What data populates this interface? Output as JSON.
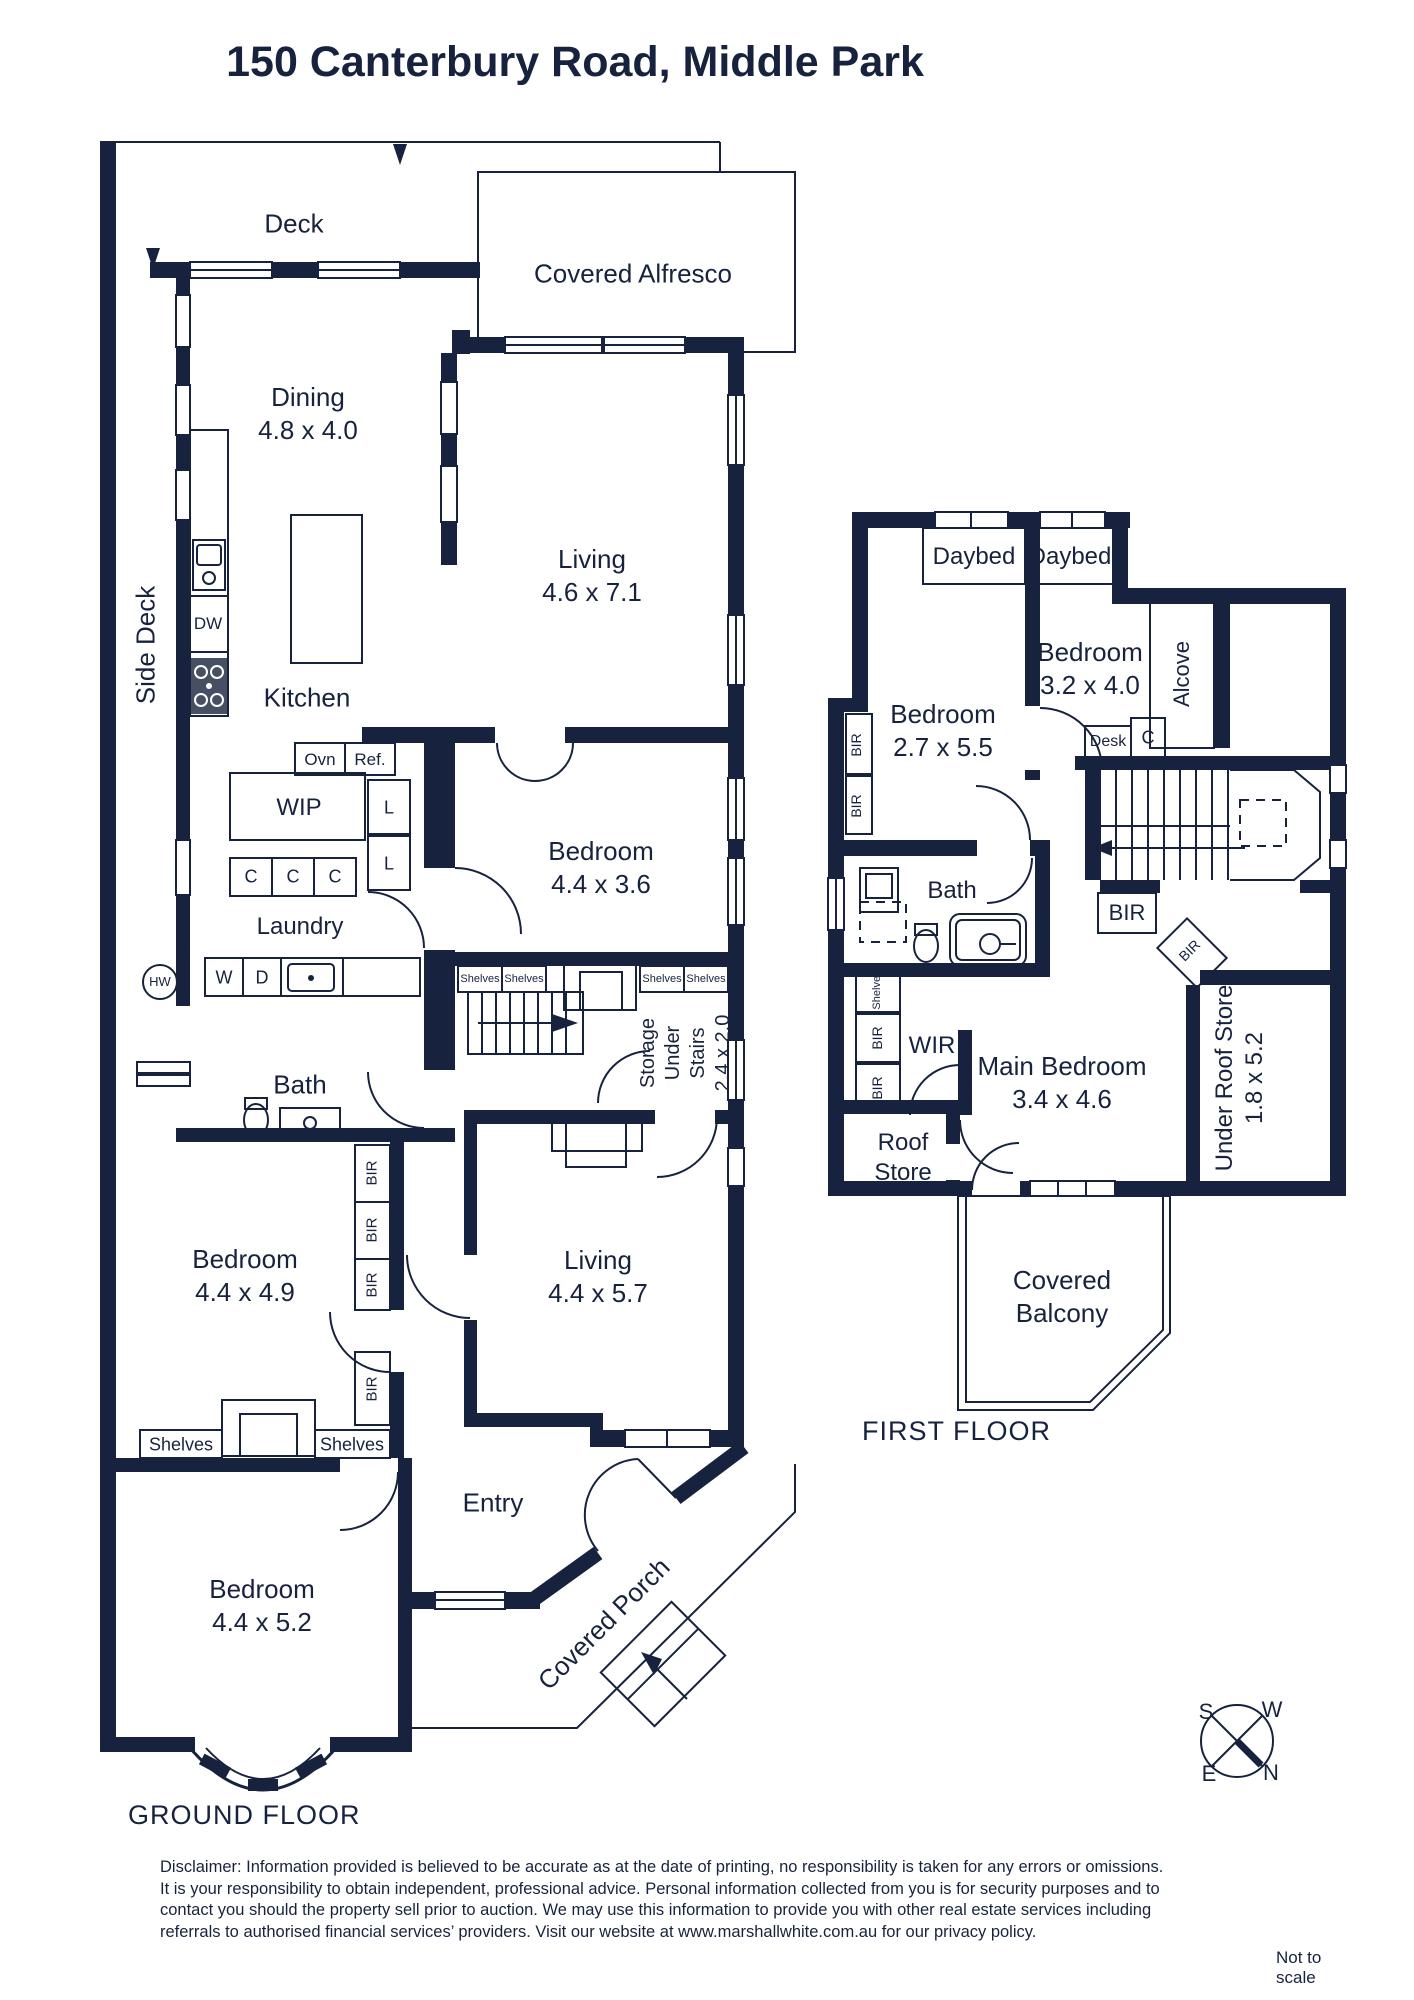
{
  "title": "150 Canterbury Road, Middle Park",
  "gf": {
    "caption": "GROUND FLOOR",
    "rooms": {
      "deck": {
        "name": "Deck"
      },
      "alfresco": {
        "name": "Covered Alfresco"
      },
      "dining": {
        "name": "Dining",
        "dims": "4.8 x 4.0"
      },
      "living1": {
        "name": "Living",
        "dims": "4.6 x 7.1"
      },
      "side_deck": {
        "name": "Side Deck"
      },
      "kitchen": {
        "name": "Kitchen"
      },
      "wip": {
        "name": "WIP"
      },
      "laundry": {
        "name": "Laundry"
      },
      "bath": {
        "name": "Bath"
      },
      "bed1": {
        "name": "Bedroom",
        "dims": "4.4 x 3.6"
      },
      "storage": {
        "l1": "Storage",
        "l2": "Under",
        "l3": "Stairs",
        "dims": "2.4 x 2.0"
      },
      "bed2": {
        "name": "Bedroom",
        "dims": "4.4 x 4.9"
      },
      "living2": {
        "name": "Living",
        "dims": "4.4 x 5.7"
      },
      "entry": {
        "name": "Entry"
      },
      "bed3": {
        "name": "Bedroom",
        "dims": "4.4 x 5.2"
      },
      "porch": {
        "name": "Covered Porch"
      }
    },
    "fixtures": {
      "dw": "DW",
      "ovn": "Ovn",
      "ref": "Ref.",
      "l": "L",
      "c": "C",
      "hw": "HW",
      "w": "W",
      "d": "D",
      "shelves": "Shelves",
      "bir": "BIR"
    }
  },
  "ff": {
    "caption": "FIRST FLOOR",
    "rooms": {
      "daybed": {
        "name": "Daybed"
      },
      "bed1": {
        "name": "Bedroom",
        "dims": "2.7 x 5.5"
      },
      "bed2": {
        "name": "Bedroom",
        "dims": "3.2 x 4.0"
      },
      "alcove": {
        "name": "Alcove"
      },
      "desk": {
        "name": "Desk"
      },
      "cupboard": {
        "name": "C"
      },
      "bath": {
        "name": "Bath"
      },
      "wir": {
        "name": "WIR"
      },
      "main_bed": {
        "name": "Main Bedroom",
        "dims": "3.4 x 4.6"
      },
      "roof_store": {
        "l1": "Roof",
        "l2": "Store"
      },
      "urs": {
        "name": "Under Roof Store",
        "dims": "1.8 x 5.2"
      },
      "balcony": {
        "l1": "Covered",
        "l2": "Balcony"
      }
    },
    "fixtures": {
      "bir": "BIR",
      "shelves": "Shelves"
    }
  },
  "compass": {
    "n": "N",
    "s": "S",
    "e": "E",
    "w": "W"
  },
  "footer": {
    "disclaimer": "Disclaimer: Information provided is believed to be accurate as at the date of printing, no responsibility is taken for any errors or omissions. It is your responsibility to obtain independent, professional advice. Personal information collected from you is for security purposes and to contact you should the property sell prior to auction. We may use this information to provide you with other real estate services including referrals to authorised financial services’ providers. Visit our website at www.marshallwhite.com.au for our privacy policy.",
    "scale_note": "Not to scale"
  }
}
